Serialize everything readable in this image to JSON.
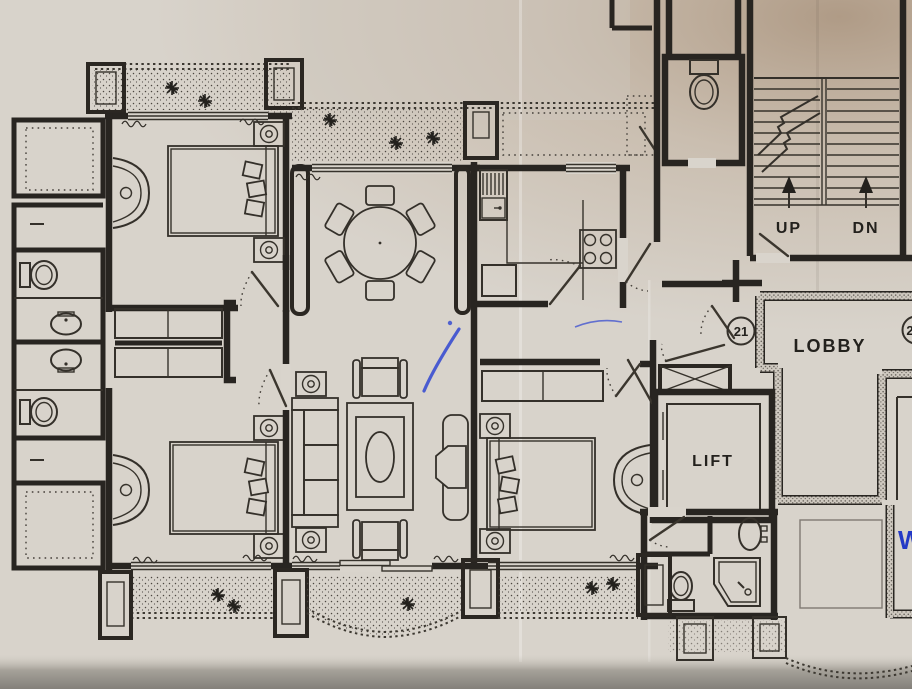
{
  "labels": {
    "stairs_up": "UP",
    "stairs_down": "DN",
    "lobby": "LOBBY",
    "lift": "LIFT",
    "unit_number": "21",
    "unit_number_partial": "2",
    "handwritten_note": "W"
  },
  "colors": {
    "paper": "#d8d3cb",
    "paper_shadow_top_right": "#ae interesse9a82",
    "ink": "#282521",
    "blue_ink": "#3a4ed0",
    "table_edge": "#8b8880"
  }
}
